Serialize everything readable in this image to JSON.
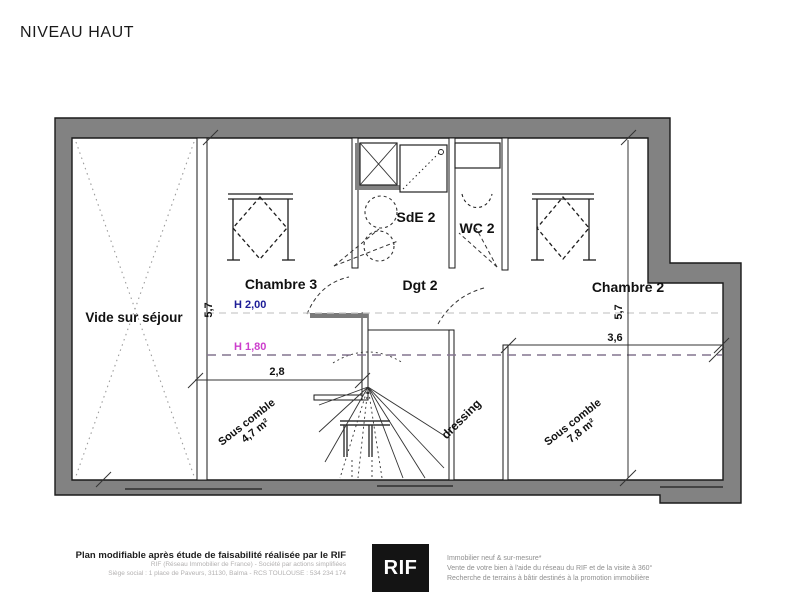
{
  "title": "NIVEAU HAUT",
  "plan": {
    "rooms": {
      "vide_sejour": "Vide sur séjour",
      "chambre3": "Chambre 3",
      "chambre2": "Chambre 2",
      "sde2": "SdE 2",
      "wc2": "WC 2",
      "dgt2": "Dgt 2",
      "dressing": "dressing",
      "sous_comble_left": {
        "line1": "Sous comble",
        "line2": "4,7 m²"
      },
      "sous_comble_right": {
        "line1": "Sous comble",
        "line2": "7,8 m²"
      }
    },
    "heights": {
      "h200": "H 2,00",
      "h180": "H 1,80"
    },
    "dimensions": {
      "left_vertical": "5,7",
      "right_vertical": "5,7",
      "bottom_left_horizontal": "2,8",
      "bottom_right_horizontal": "3,6"
    },
    "colors": {
      "wall_fill": "#828282",
      "h200_text": "#1c1c96",
      "h180_text": "#cc3ecc",
      "h200_line": "#c9c9c9",
      "h180_line": "#83758f"
    }
  },
  "footer": {
    "left": {
      "bold": "Plan modifiable après étude de faisabilité réalisée par le RIF",
      "line1": "RIF (Réseau Immobilier de France)  -  Société par actions simplifiées",
      "line2": "Siège social : 1 place de Paveurs, 31130, Balma  -  RCS TOULOUSE : 534 234 174"
    },
    "logo": "RIF",
    "right": {
      "line1": "Immobilier neuf & sur-mesure*",
      "line2": "Vente de votre bien à l'aide du réseau du RIF et de la visite à 360°",
      "line3": "Recherche de terrains à bâtir destinés à la promotion immobilière"
    }
  }
}
